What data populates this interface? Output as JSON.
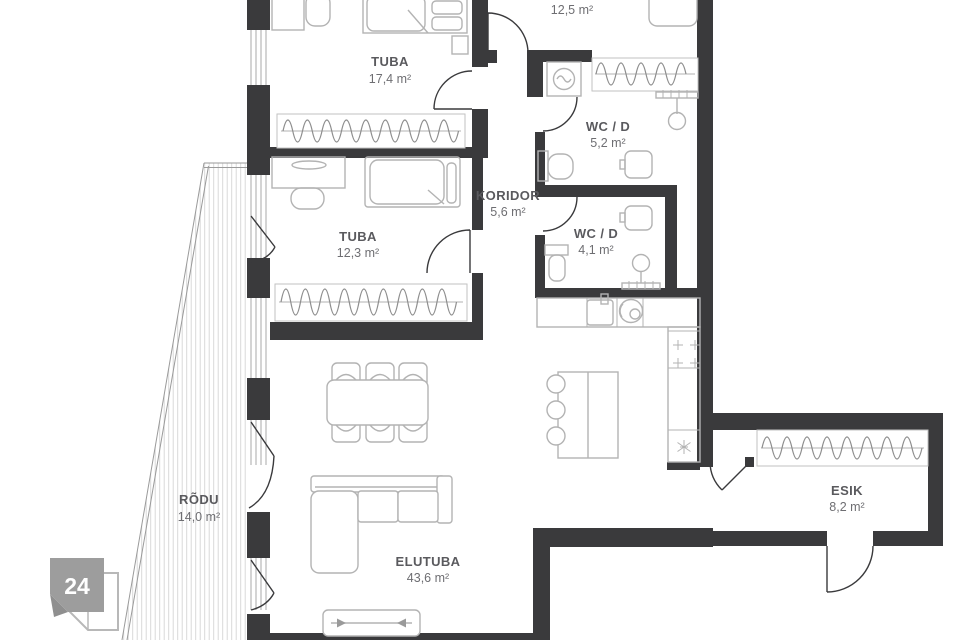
{
  "plan": {
    "badge": "24",
    "rooms": {
      "tuba_1": {
        "name": "TUBA",
        "area": "17,4 m²"
      },
      "room_12_5": {
        "area": "12,5 m²"
      },
      "wc_d_1": {
        "name": "WC / D",
        "area": "5,2 m²"
      },
      "koridor": {
        "name": "KORIDOR",
        "area": "5,6 m²"
      },
      "wc_d_2": {
        "name": "WC / D",
        "area": "4,1 m²"
      },
      "tuba_2": {
        "name": "TUBA",
        "area": "12,3 m²"
      },
      "rodu": {
        "name": "RÕDU",
        "area": "14,0 m²"
      },
      "elutuba": {
        "name": "ELUTUBA",
        "area": "43,6 m²"
      },
      "esik": {
        "name": "ESIK",
        "area": "8,2 m²"
      }
    },
    "colors": {
      "wall": "#3a3a3c",
      "furniture_outline": "#b3b3b3",
      "room_label": "#5a5a5e",
      "area_label": "#6e6e72",
      "balcony_hatch": "#d9d9d9",
      "badge_fill": "#9d9d9d"
    }
  }
}
